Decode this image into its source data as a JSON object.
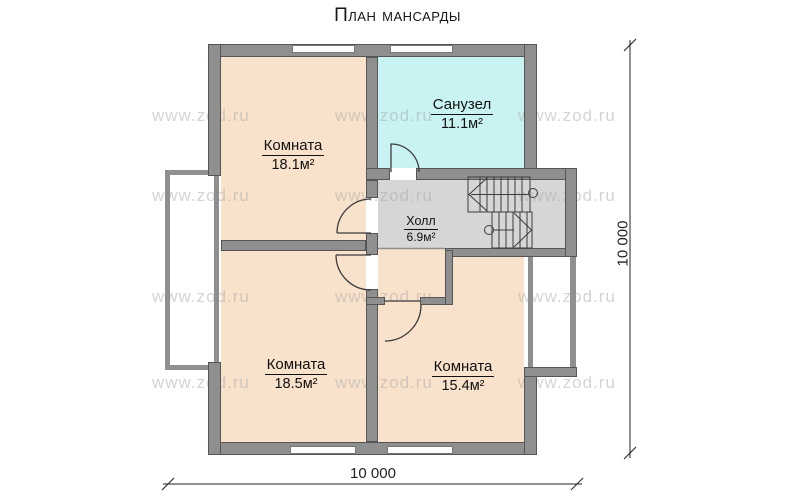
{
  "title": "План мансарды",
  "watermark": "www.zod.ru",
  "rooms": [
    {
      "id": "room-18-1",
      "name": "Комната",
      "area": "18.1м²"
    },
    {
      "id": "bathroom",
      "name": "Санузел",
      "area": "11.1м²"
    },
    {
      "id": "hall",
      "name": "Холл",
      "area": "6.9м²"
    },
    {
      "id": "room-18-5",
      "name": "Комната",
      "area": "18.5м²"
    },
    {
      "id": "room-15-4",
      "name": "Комната",
      "area": "15.4м²"
    }
  ],
  "dimensions": {
    "right": "10 000",
    "bottom": "10 000"
  },
  "colors": {
    "room_fill": "#f9e2cb",
    "bathroom_fill": "#c9f2f2",
    "hall_fill": "#d6d6d6",
    "wall": "#8f8f8f",
    "wall_outline": "#565656",
    "watermark": "#aaaaaa",
    "dimension": "#222222"
  }
}
